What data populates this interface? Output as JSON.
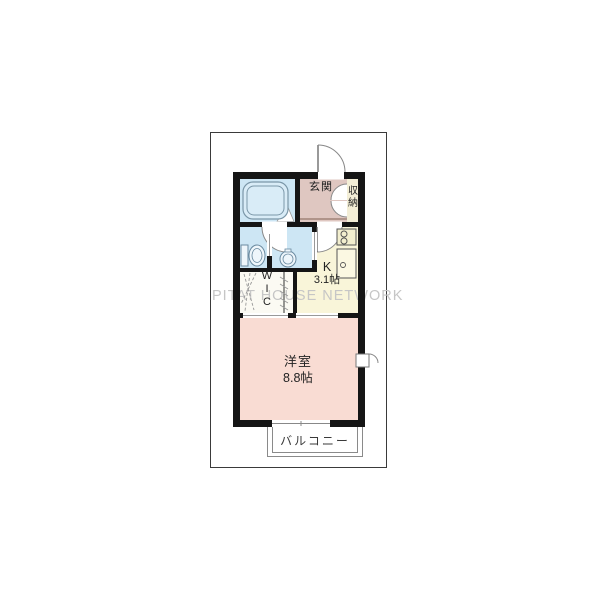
{
  "floorplan": {
    "watermark": "PITAT HOUSE NETWORK",
    "rooms": {
      "entrance": {
        "label": "玄関"
      },
      "storage": {
        "label": "収納"
      },
      "kitchen": {
        "label": "K",
        "size": "3.1帖"
      },
      "wic": {
        "label": "WIC",
        "letters": [
          "W",
          "I",
          "C"
        ]
      },
      "living": {
        "label": "洋室",
        "size": "8.8帖"
      },
      "balcony": {
        "label": "バルコニー"
      }
    },
    "fixtures": [
      "bathtub-icon",
      "toilet-icon",
      "washbasin-icon",
      "stove-icon",
      "kitchen-sink-icon"
    ],
    "colors": {
      "wall": "#151515",
      "wet_area_floor": "#cde6f4",
      "entrance_floor": "#dfc7c1",
      "storage_floor": "#f3eed6",
      "kitchen_floor": "#f9f5d9",
      "living_floor": "#f9dcd3",
      "wic_floor": "#fbfaf3",
      "watermark": "#c6c6c6"
    }
  }
}
